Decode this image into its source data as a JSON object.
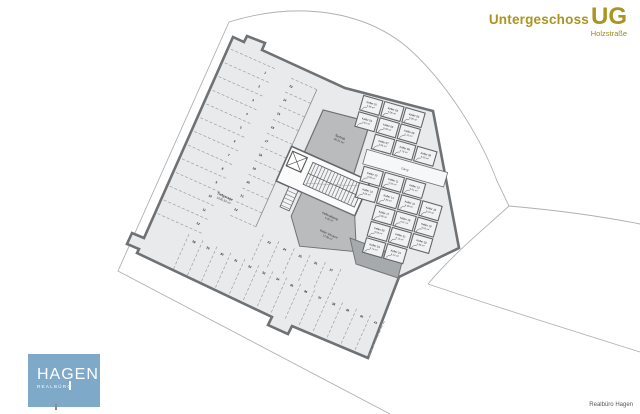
{
  "header": {
    "title": "Untergeschoss",
    "title_abbr": "UG",
    "subtitle": "Holzstraße"
  },
  "footer": {
    "credit": "Realbüro Hagen",
    "logo_text": "HAGEN",
    "logo_subtext": "REALBÜRO"
  },
  "colors": {
    "accent_gold": "#ab941f",
    "logo_blue": "#7ea9c9",
    "wall_gray": "#6f7275",
    "floor_gray": "#e9eaec",
    "service_gray": "#b9bbbd"
  },
  "plan": {
    "labels": {
      "garage": {
        "name": "Tiefgarage",
        "area": "1026.50 m²"
      },
      "technik": {
        "name": "Technik",
        "area": "46.27 m²"
      },
      "kellerabgang": {
        "name": "Kellerabgang",
        "area": "5.30 m²"
      },
      "vorraum": {
        "name": "Keller Vorraum",
        "area": "17.86 m²"
      },
      "gang": "Gang"
    },
    "parking": {
      "left_bank": [
        "1",
        "2",
        "3",
        "4",
        "5",
        "6",
        "7",
        "8",
        "9",
        "10",
        "11",
        "12"
      ],
      "middle_bank": [
        "13",
        "14",
        "15",
        "16",
        "17",
        "18",
        "19",
        "20",
        "21",
        "22"
      ],
      "center_bank": [
        "23",
        "24",
        "25",
        "26",
        "27"
      ],
      "bottom_bank": [
        "28",
        "29",
        "30",
        "31",
        "32",
        "33",
        "34",
        "35",
        "36",
        "37",
        "38",
        "39",
        "40",
        "41"
      ]
    },
    "keller_rooms": [
      {
        "label": "Keller 01",
        "area": "4.56 m²"
      },
      {
        "label": "Keller 02",
        "area": "5.06 m²"
      },
      {
        "label": "Keller 03",
        "area": "5.06 m²"
      },
      {
        "label": "Keller 04",
        "area": "4.81 m²"
      },
      {
        "label": "Keller 05",
        "area": "5.06 m²"
      },
      {
        "label": "Keller 06",
        "area": "5.12 m²"
      },
      {
        "label": "Keller 07",
        "area": "5.06 m²"
      },
      {
        "label": "Keller 08",
        "area": "4.78 m²"
      },
      {
        "label": "Keller 09",
        "area": "5.20 m²"
      },
      {
        "label": "Keller 10",
        "area": "5.06 m²"
      },
      {
        "label": "Keller 11",
        "area": "4.92 m²"
      },
      {
        "label": "Keller 12",
        "area": "5.31 m²"
      },
      {
        "label": "Keller 13",
        "area": "5.06 m²"
      },
      {
        "label": "Keller 14",
        "area": "4.85 m²"
      },
      {
        "label": "Keller 15",
        "area": "5.06 m²"
      },
      {
        "label": "Keller 16",
        "area": "5.44 m²"
      },
      {
        "label": "Keller 17",
        "area": "5.06 m²"
      },
      {
        "label": "Keller 18",
        "area": "4.97 m²"
      },
      {
        "label": "Keller 19",
        "area": "5.63 m²"
      },
      {
        "label": "Keller 20",
        "area": "5.06 m²"
      },
      {
        "label": "Keller 21",
        "area": "5.12 m²"
      },
      {
        "label": "Keller 22",
        "area": "4.88 m²"
      },
      {
        "label": "Keller 23",
        "area": "5.74 m²"
      },
      {
        "label": "Keller 24",
        "area": "6.12 m²"
      }
    ]
  }
}
